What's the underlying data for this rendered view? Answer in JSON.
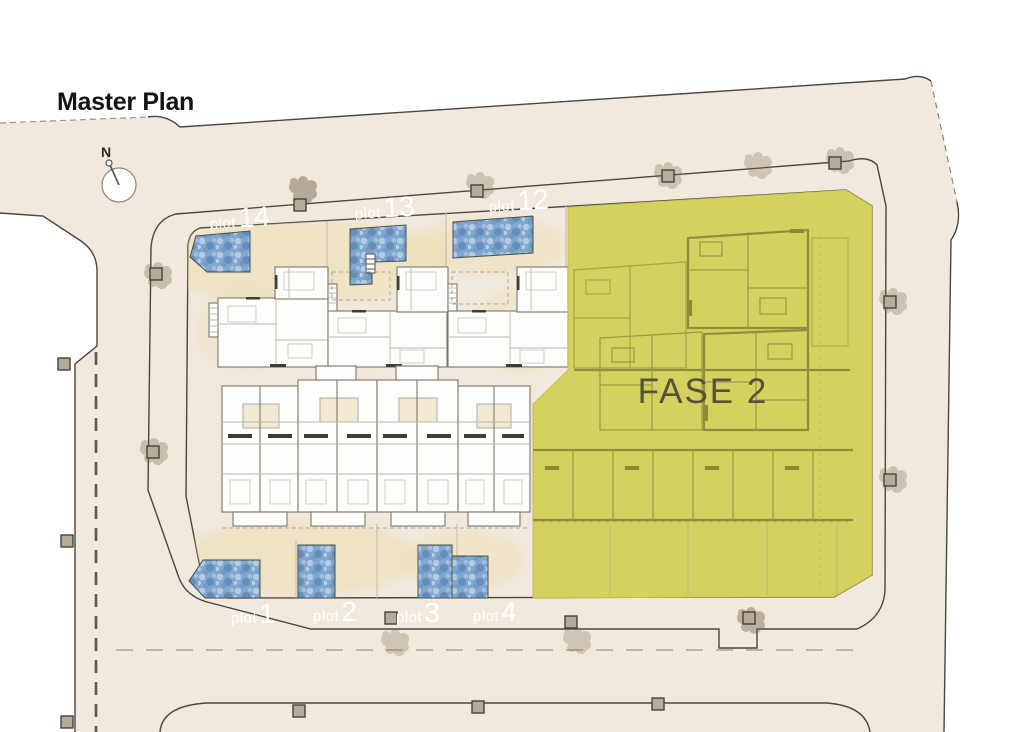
{
  "title": "Master Plan",
  "compass": {
    "label": "N"
  },
  "phase": {
    "label": "FASE 2"
  },
  "plots": {
    "top": [
      {
        "prefix": "plot",
        "number": "14"
      },
      {
        "prefix": "plot",
        "number": "13"
      },
      {
        "prefix": "plot",
        "number": "12"
      }
    ],
    "bottom": [
      {
        "prefix": "plot",
        "number": "1"
      },
      {
        "prefix": "plot",
        "number": "2"
      },
      {
        "prefix": "plot",
        "number": "3"
      },
      {
        "prefix": "plot",
        "number": "4"
      }
    ]
  },
  "colors": {
    "page_bg": "#ffffff",
    "street": "#f1e9dd",
    "road_band": "#aaa092",
    "plot_ground": "#f8f1de",
    "ground_wash": "#eedcab",
    "pool": "#7fa7cf",
    "phase_fill": "#d4d15e",
    "phase_line": "#9c9c44",
    "phase_text": "#54523e",
    "outline": "#4a473f",
    "post_fill": "#b6ab9a",
    "building_fill": "#fdfdfb",
    "label_text": "#ffffff",
    "title_text": "#141414",
    "tree": "#7a6c55",
    "block_fill": "#ffffff"
  }
}
